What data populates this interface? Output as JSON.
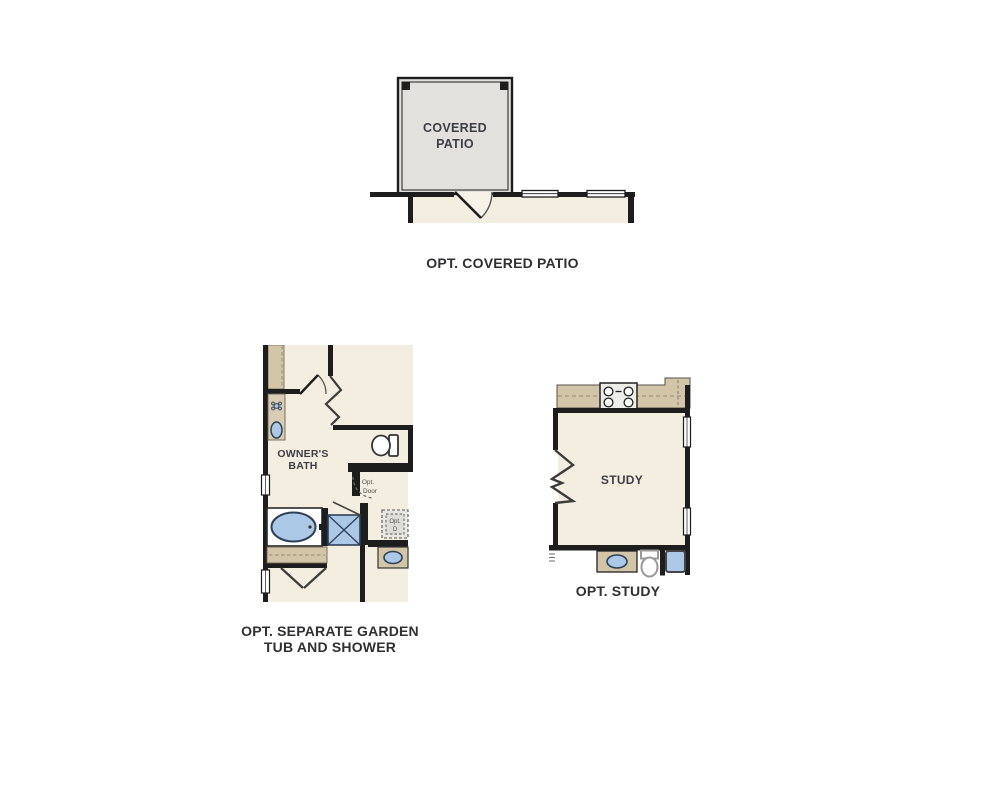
{
  "document": {
    "type": "floor-plan-options-sheet",
    "background": "#ffffff"
  },
  "colors": {
    "wall": "#1d1d1d",
    "floor": "#f4eee1",
    "patio_fill": "#e2e1de",
    "counter_tan": "#d3c6a8",
    "fixture_blue": "#abc8e6",
    "fixture_outline": "#2e4057",
    "dashed_line": "#a2977e",
    "room_label": "#3d3d46",
    "caption": "#303032",
    "annotation": "#524f49"
  },
  "patio_plan": {
    "room_label_line1": "COVERED",
    "room_label_line2": "PATIO",
    "caption": "OPT. COVERED PATIO"
  },
  "bath_plan": {
    "room_label_line1": "OWNER'S",
    "room_label_line2": "BATH",
    "opt_door_label_line1": "Opt.",
    "opt_door_label_line2": "Door",
    "opt_d_label_line1": "Opt.",
    "opt_d_label_line2": "D",
    "caption_line1": "OPT. SEPARATE GARDEN",
    "caption_line2": "TUB AND SHOWER"
  },
  "study_plan": {
    "room_label": "STUDY",
    "caption": "OPT. STUDY"
  }
}
